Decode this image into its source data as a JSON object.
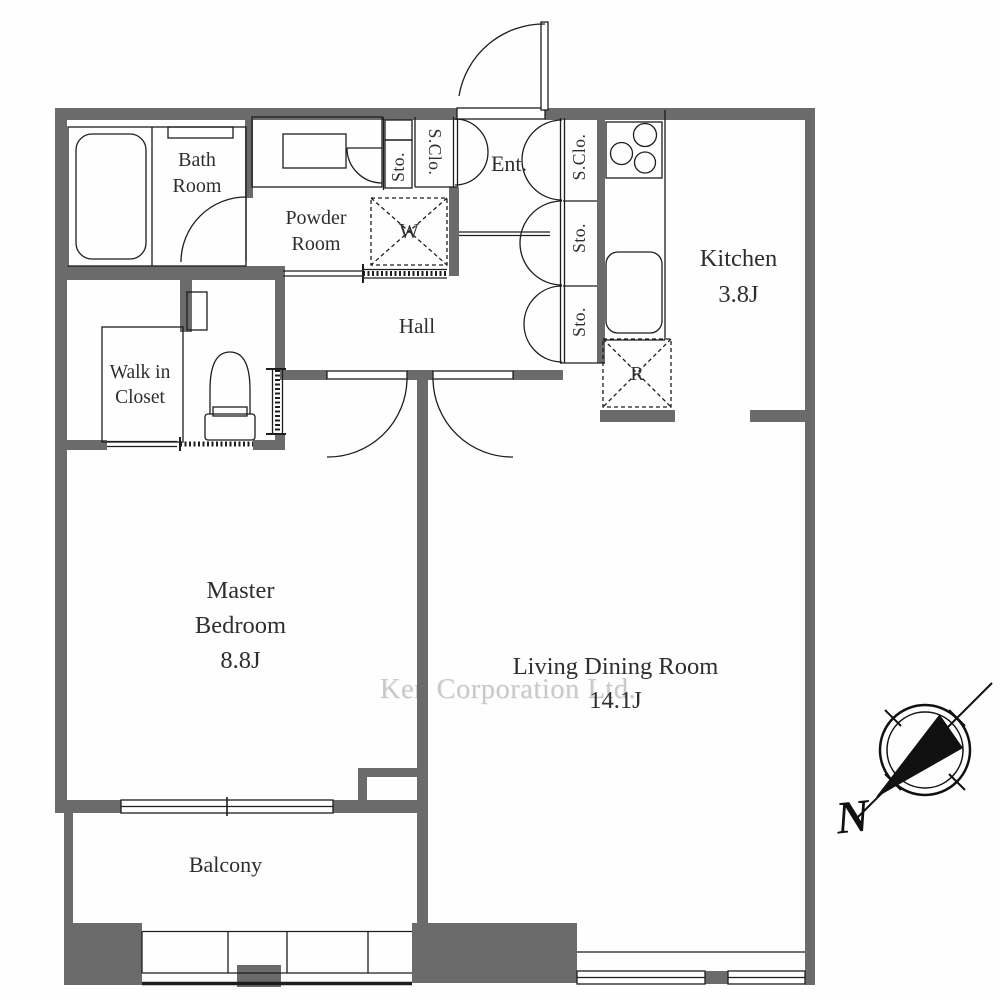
{
  "floorplan": {
    "rooms": {
      "bath": {
        "line1": "Bath",
        "line2": "Room"
      },
      "powder": {
        "line1": "Powder",
        "line2": "Room"
      },
      "wic": {
        "line1": "Walk in",
        "line2": "Closet"
      },
      "hall": {
        "name": "Hall"
      },
      "entrance": {
        "name": "Ent."
      },
      "kitchen": {
        "name": "Kitchen",
        "area": "3.8J"
      },
      "master_bedroom": {
        "line1": "Master",
        "line2": "Bedroom",
        "area": "8.8J"
      },
      "living_dining": {
        "name": "Living Dining Room",
        "area": "14.1J"
      },
      "balcony": {
        "name": "Balcony"
      }
    },
    "closets": {
      "s_clo_left": "S.Clo.",
      "sto_powder": "Sto.",
      "s_clo_entrance": "S.Clo.",
      "sto_upper": "Sto.",
      "sto_lower": "Sto."
    },
    "appliances": {
      "washer_label": "W",
      "refrigerator_label": "R"
    },
    "compass": {
      "north_label": "N"
    },
    "watermark": {
      "text": "Ken Corporation Ltd."
    },
    "colors": {
      "wall": "#6b6b6b",
      "line": "#1d1d1d",
      "watermark": "#c9c9c9"
    }
  }
}
